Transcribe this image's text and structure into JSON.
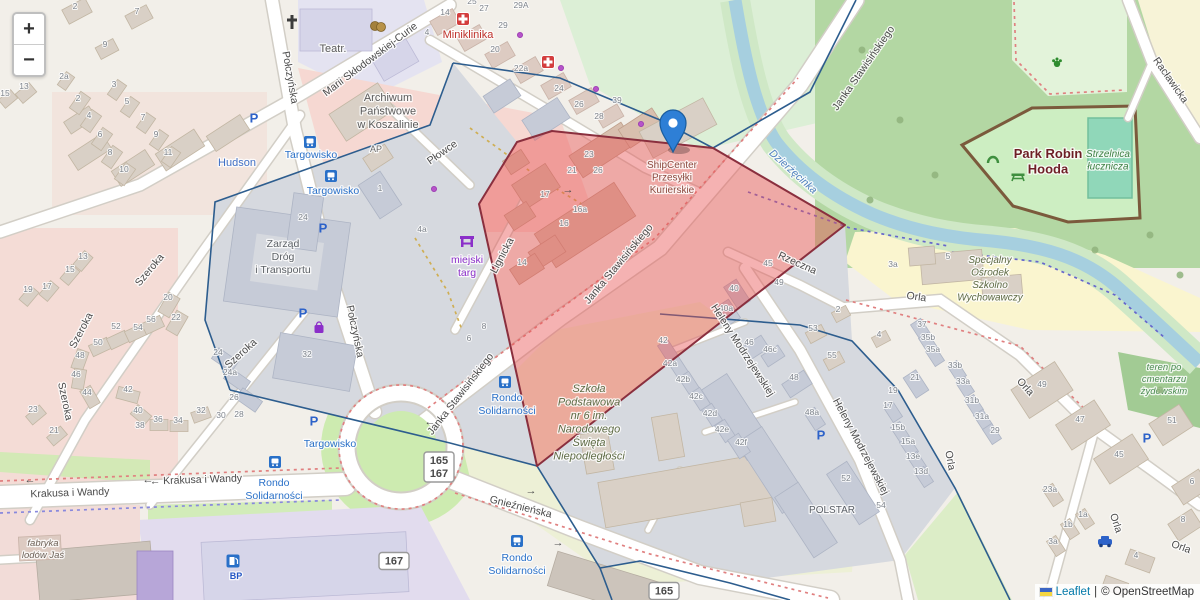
{
  "controls": {
    "zoom_in": "+",
    "zoom_out": "−"
  },
  "attribution": {
    "flag": "ukraine-flag",
    "leaflet": "Leaflet",
    "separator": "|",
    "osm": "© OpenStreetMap"
  },
  "marker": {
    "title_lines": [
      "ShipCenter",
      "Przesyłki",
      "Kurierskie"
    ],
    "x": 672,
    "y": 168
  },
  "colors": {
    "highlight_fill": "rgba(233,84,84,0.45)",
    "highlight_stroke": "#8a2f3e",
    "boundary": "#2d5d8e",
    "water": "#a6cfdf",
    "park": "#cdeec2",
    "road": "#ffffff",
    "marker_blue": "#2e7fd6",
    "transit_label": "#2970c8",
    "health_red": "#bf312b",
    "shop_purple": "#8b2fc9",
    "school_label": "#5e6b45",
    "attribution_link": "#0078A8"
  },
  "badges": [
    {
      "lines": [
        "165",
        "167"
      ],
      "x": 439,
      "y": 467
    },
    {
      "lines": [
        "167"
      ],
      "x": 394,
      "y": 561
    },
    {
      "lines": [
        "165"
      ],
      "x": 664,
      "y": 591
    }
  ],
  "streets": [
    {
      "text": "Połczyńska",
      "x": 287,
      "y": 78,
      "rot": 80
    },
    {
      "text": "Połczyńska",
      "x": 352,
      "y": 332,
      "rot": 78
    },
    {
      "text": "Marii Skłodowskiej-Curie",
      "x": 372,
      "y": 62,
      "rot": -37
    },
    {
      "text": "Płowce",
      "x": 444,
      "y": 155,
      "rot": -35
    },
    {
      "text": "Szeroka",
      "x": 152,
      "y": 272,
      "rot": -50
    },
    {
      "text": "Szeroka",
      "x": 84,
      "y": 332,
      "rot": -62
    },
    {
      "text": "Szeroka",
      "x": 62,
      "y": 402,
      "rot": 78
    },
    {
      "text": "Szeroka",
      "x": 243,
      "y": 356,
      "rot": -42
    },
    {
      "text": "Lignicka",
      "x": 505,
      "y": 257,
      "rot": -62
    },
    {
      "text": "Janka Stawisińskiego",
      "x": 463,
      "y": 396,
      "rot": -52
    },
    {
      "text": "Janka Stawisińskiego",
      "x": 621,
      "y": 266,
      "rot": -50
    },
    {
      "text": "Janka Stawisińskiego",
      "x": 866,
      "y": 70,
      "rot": -55
    },
    {
      "text": "Krakusa i Wandy",
      "x": 70,
      "y": 496,
      "rot": -2
    },
    {
      "text": "← Krakusa i Wandy",
      "x": 196,
      "y": 483,
      "rot": -2
    },
    {
      "text": "Gnieźnieńska",
      "x": 520,
      "y": 510,
      "rot": 14
    },
    {
      "text": "Heleny Modrzejewskiej",
      "x": 740,
      "y": 352,
      "rot": 57
    },
    {
      "text": "Heleny Modrzejewskiej",
      "x": 858,
      "y": 448,
      "rot": 62
    },
    {
      "text": "Orla",
      "x": 916,
      "y": 300,
      "rot": 8
    },
    {
      "text": "Orla",
      "x": 1023,
      "y": 389,
      "rot": 48
    },
    {
      "text": "Orla",
      "x": 947,
      "y": 461,
      "rot": 80
    },
    {
      "text": "Orla",
      "x": 1113,
      "y": 524,
      "rot": 72
    },
    {
      "text": "Orla",
      "x": 1180,
      "y": 550,
      "rot": 20
    },
    {
      "text": "Rzeczna",
      "x": 796,
      "y": 266,
      "rot": 24
    },
    {
      "text": "Racławicka",
      "x": 1168,
      "y": 82,
      "rot": 55
    },
    {
      "text": "Dzierżęcinka",
      "x": 791,
      "y": 174,
      "rot": 42,
      "water": true
    }
  ],
  "places": [
    {
      "lines": [
        "Teatr."
      ],
      "x": 333,
      "y": 52,
      "color": "#5a5a5a",
      "size": 11
    },
    {
      "lines": [
        "Miniklinika"
      ],
      "x": 468,
      "y": 38,
      "color": "#bf312b",
      "size": 11
    },
    {
      "lines": [
        "Archiwum",
        "Państwowe",
        "w Koszalinie"
      ],
      "x": 388,
      "y": 101,
      "color": "#5a5a5a",
      "size": 11
    },
    {
      "lines": [
        "AP"
      ],
      "x": 376,
      "y": 152,
      "color": "#6a6a6a",
      "size": 9
    },
    {
      "lines": [
        "Hudson"
      ],
      "x": 237,
      "y": 166,
      "color": "#3f6fc4",
      "size": 11
    },
    {
      "lines": [
        "Targowisko"
      ],
      "x": 311,
      "y": 158,
      "color": "#2970c8",
      "size": 10.5
    },
    {
      "lines": [
        "Targowisko"
      ],
      "x": 333,
      "y": 194,
      "color": "#2970c8",
      "size": 10.5
    },
    {
      "lines": [
        "Targowisko"
      ],
      "x": 330,
      "y": 447,
      "color": "#2970c8",
      "size": 10.5
    },
    {
      "lines": [
        "Zarząd",
        "Dróg",
        "i Transportu"
      ],
      "x": 283,
      "y": 247,
      "color": "#5c6166",
      "size": 10.5
    },
    {
      "lines": [
        "miejski",
        "targ"
      ],
      "x": 467,
      "y": 263,
      "color": "#8b2fc9",
      "size": 10.5
    },
    {
      "lines": [
        "Rondo",
        "Solidarności"
      ],
      "x": 507,
      "y": 401,
      "color": "#2970c8",
      "size": 10.5
    },
    {
      "lines": [
        "Rondo",
        "Solidarności"
      ],
      "x": 274,
      "y": 486,
      "color": "#2970c8",
      "size": 10.5
    },
    {
      "lines": [
        "Rondo",
        "Solidarności"
      ],
      "x": 517,
      "y": 561,
      "color": "#2970c8",
      "size": 10.5
    },
    {
      "lines": [
        "Szkoła",
        "Podstawowa",
        "nr 6 im.",
        "Narodowego",
        "Święta",
        "Niepodległości"
      ],
      "x": 589,
      "y": 392,
      "color": "#5e6b45",
      "size": 11,
      "italic": true
    },
    {
      "lines": [
        "POLSTAR"
      ],
      "x": 832,
      "y": 513,
      "color": "#5a5f66",
      "size": 10
    },
    {
      "lines": [
        "Park Robin",
        "Hooda"
      ],
      "x": 1048,
      "y": 158,
      "color": "#6e1f26",
      "size": 13,
      "bold": true
    },
    {
      "lines": [
        "Strzelnica",
        "łucznicza"
      ],
      "x": 1108,
      "y": 157,
      "color": "#3e7f43",
      "size": 10,
      "italic": true
    },
    {
      "lines": [
        "Specjalny",
        "Ośrodek",
        "Szkolno",
        "Wychowawczy"
      ],
      "x": 990,
      "y": 263,
      "color": "#5e6b45",
      "size": 10,
      "italic": true
    },
    {
      "lines": [
        "teren po",
        "cmentarzu",
        "żydowskim"
      ],
      "x": 1164,
      "y": 370,
      "color": "#4a8a50",
      "size": 9.5,
      "italic": true
    },
    {
      "lines": [
        "fabryka",
        "lodów Jaś"
      ],
      "x": 43,
      "y": 546,
      "color": "#6e6258",
      "size": 9.5,
      "italic": true
    },
    {
      "lines": [
        "BP"
      ],
      "x": 236,
      "y": 579,
      "color": "#2456c4",
      "size": 9,
      "bold": true
    }
  ],
  "house_numbers": [
    [
      "2",
      75,
      9
    ],
    [
      "7",
      137,
      14
    ],
    [
      "9",
      105,
      47
    ],
    [
      "2a",
      64,
      79
    ],
    [
      "13",
      24,
      89
    ],
    [
      "15",
      5,
      96
    ],
    [
      "3",
      114,
      87
    ],
    [
      "5",
      127,
      104
    ],
    [
      "7",
      143,
      120
    ],
    [
      "9",
      156,
      137
    ],
    [
      "11",
      168,
      155
    ],
    [
      "2",
      78,
      101
    ],
    [
      "4",
      89,
      118
    ],
    [
      "6",
      100,
      137
    ],
    [
      "8",
      110,
      155
    ],
    [
      "10",
      124,
      172
    ],
    [
      "25",
      472,
      4
    ],
    [
      "27",
      484,
      11
    ],
    [
      "29",
      503,
      28
    ],
    [
      "29A",
      521,
      8
    ],
    [
      "14",
      445,
      15
    ],
    [
      "4",
      427,
      35
    ],
    [
      "20",
      495,
      52
    ],
    [
      "22a",
      521,
      71
    ],
    [
      "24",
      559,
      91
    ],
    [
      "26",
      579,
      107
    ],
    [
      "28",
      599,
      119
    ],
    [
      "39",
      617,
      103
    ],
    [
      "13",
      83,
      259
    ],
    [
      "15",
      70,
      272
    ],
    [
      "17",
      47,
      289
    ],
    [
      "19",
      28,
      292
    ],
    [
      "20",
      168,
      300
    ],
    [
      "22",
      176,
      320
    ],
    [
      "52",
      116,
      329
    ],
    [
      "54",
      138,
      330
    ],
    [
      "56",
      151,
      322
    ],
    [
      "50",
      98,
      345
    ],
    [
      "48",
      80,
      358
    ],
    [
      "46",
      76,
      377
    ],
    [
      "44",
      87,
      395
    ],
    [
      "42",
      128,
      392
    ],
    [
      "40",
      138,
      413
    ],
    [
      "38",
      140,
      428
    ],
    [
      "36",
      158,
      422
    ],
    [
      "34",
      178,
      423
    ],
    [
      "32",
      201,
      413
    ],
    [
      "30",
      221,
      418
    ],
    [
      "28",
      239,
      417
    ],
    [
      "26",
      234,
      400
    ],
    [
      "24a",
      230,
      375
    ],
    [
      "24",
      218,
      355
    ],
    [
      "21",
      54,
      433
    ],
    [
      "23",
      33,
      412
    ],
    [
      "32",
      307,
      357
    ],
    [
      "24",
      303,
      220
    ],
    [
      "1",
      380,
      191
    ],
    [
      "4a",
      422,
      232
    ],
    [
      "23",
      589,
      157
    ],
    [
      "21",
      572,
      173
    ],
    [
      "26",
      598,
      173
    ],
    [
      "17",
      545,
      197
    ],
    [
      "16a",
      580,
      212
    ],
    [
      "16",
      564,
      226
    ],
    [
      "14",
      522,
      265
    ],
    [
      "6",
      469,
      341
    ],
    [
      "8",
      484,
      329
    ],
    [
      "42",
      663,
      343
    ],
    [
      "42a",
      670,
      366
    ],
    [
      "42b",
      683,
      382
    ],
    [
      "42c",
      696,
      399
    ],
    [
      "42d",
      710,
      416
    ],
    [
      "42e",
      722,
      432
    ],
    [
      "42f",
      741,
      445
    ],
    [
      "40",
      734,
      291
    ],
    [
      "40a",
      726,
      311
    ],
    [
      "46",
      749,
      345
    ],
    [
      "46c",
      770,
      352
    ],
    [
      "48",
      794,
      380
    ],
    [
      "48a",
      812,
      415
    ],
    [
      "49",
      779,
      285
    ],
    [
      "45",
      768,
      266
    ],
    [
      "53",
      813,
      331
    ],
    [
      "55",
      832,
      358
    ],
    [
      "2",
      838,
      312
    ],
    [
      "4",
      879,
      337
    ],
    [
      "37",
      922,
      327
    ],
    [
      "35b",
      928,
      340
    ],
    [
      "35a",
      933,
      352
    ],
    [
      "33b",
      955,
      368
    ],
    [
      "33a",
      963,
      384
    ],
    [
      "31b",
      972,
      403
    ],
    [
      "31a",
      982,
      419
    ],
    [
      "29",
      995,
      433
    ],
    [
      "21",
      915,
      380
    ],
    [
      "19",
      893,
      393
    ],
    [
      "17",
      888,
      408
    ],
    [
      "15b",
      898,
      430
    ],
    [
      "15a",
      908,
      444
    ],
    [
      "13e",
      913,
      459
    ],
    [
      "13d",
      921,
      474
    ],
    [
      "52",
      846,
      481
    ],
    [
      "54",
      881,
      508
    ],
    [
      "3a",
      893,
      267
    ],
    [
      "5",
      948,
      259
    ],
    [
      "49",
      1042,
      387
    ],
    [
      "47",
      1080,
      422
    ],
    [
      "51",
      1172,
      423
    ],
    [
      "45",
      1119,
      457
    ],
    [
      "23a",
      1050,
      492
    ],
    [
      "1a",
      1083,
      517
    ],
    [
      "1b",
      1068,
      527
    ],
    [
      "3a",
      1053,
      544
    ],
    [
      "6",
      1192,
      484
    ],
    [
      "8",
      1183,
      522
    ],
    [
      "4",
      1136,
      558
    ]
  ],
  "icons": [
    {
      "type": "church",
      "x": 292,
      "y": 22
    },
    {
      "type": "theater",
      "x": 378,
      "y": 26
    },
    {
      "type": "medical",
      "x": 463,
      "y": 19
    },
    {
      "type": "medical",
      "x": 548,
      "y": 62
    },
    {
      "type": "market",
      "x": 467,
      "y": 241
    },
    {
      "type": "shopping-bag",
      "x": 319,
      "y": 328
    },
    {
      "type": "parking",
      "x": 254,
      "y": 118
    },
    {
      "type": "parking",
      "x": 323,
      "y": 228
    },
    {
      "type": "parking",
      "x": 303,
      "y": 313
    },
    {
      "type": "parking",
      "x": 314,
      "y": 421
    },
    {
      "type": "parking",
      "x": 821,
      "y": 435
    },
    {
      "type": "parking",
      "x": 1147,
      "y": 438
    },
    {
      "type": "bus-stop",
      "x": 310,
      "y": 142
    },
    {
      "type": "bus-stop",
      "x": 331,
      "y": 176
    },
    {
      "type": "bus-stop",
      "x": 275,
      "y": 462
    },
    {
      "type": "bus-stop",
      "x": 505,
      "y": 382
    },
    {
      "type": "bus-stop",
      "x": 517,
      "y": 541
    },
    {
      "type": "fuel",
      "x": 233,
      "y": 561
    },
    {
      "type": "car",
      "x": 1105,
      "y": 542
    },
    {
      "type": "picnic-table",
      "x": 1018,
      "y": 176
    },
    {
      "type": "playground-arch",
      "x": 993,
      "y": 158
    },
    {
      "type": "paw",
      "x": 1057,
      "y": 62
    },
    {
      "type": "poi-dot",
      "x": 520,
      "y": 35
    },
    {
      "type": "poi-dot",
      "x": 561,
      "y": 68
    },
    {
      "type": "poi-dot",
      "x": 596,
      "y": 89
    },
    {
      "type": "poi-dot",
      "x": 641,
      "y": 124
    },
    {
      "type": "poi-dot",
      "x": 434,
      "y": 189
    },
    {
      "type": "arrow-left",
      "x": 148,
      "y": 480
    },
    {
      "type": "arrow-left",
      "x": 30,
      "y": 480
    },
    {
      "type": "arrow-right",
      "x": 531,
      "y": 491
    },
    {
      "type": "arrow-left",
      "x": 430,
      "y": 422
    },
    {
      "type": "arrow-right",
      "x": 568,
      "y": 190
    },
    {
      "type": "arrow-right",
      "x": 558,
      "y": 543
    },
    {
      "type": "tree",
      "x": 862,
      "y": 50
    },
    {
      "type": "tree",
      "x": 900,
      "y": 120
    },
    {
      "type": "tree",
      "x": 935,
      "y": 175
    },
    {
      "type": "tree",
      "x": 1150,
      "y": 235
    },
    {
      "type": "tree",
      "x": 1180,
      "y": 275
    },
    {
      "type": "tree",
      "x": 1095,
      "y": 250
    },
    {
      "type": "tree",
      "x": 870,
      "y": 200
    },
    {
      "type": "tree",
      "x": 1160,
      "y": 390
    }
  ]
}
